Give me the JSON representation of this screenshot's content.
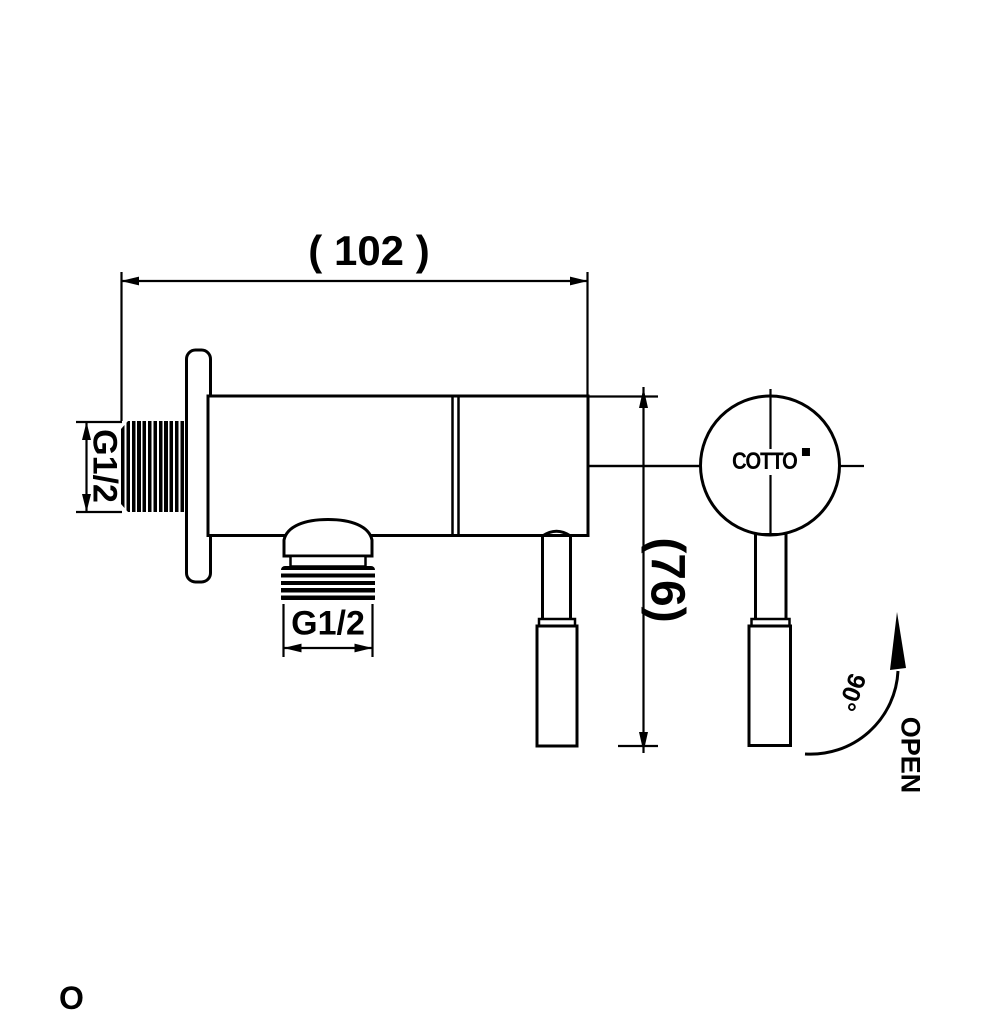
{
  "drawing_labels": {
    "width_dimension": "( 102 )",
    "height_dimension": "(76)",
    "inlet_thread": "G1/2",
    "outlet_thread": "G1/2",
    "brand_logo": "COTTO",
    "rotation_angle": "90°",
    "open_direction": "OPEN",
    "bottom_left_partial_letter": "O"
  },
  "colors": {
    "line": "#000000",
    "background": "#ffffff"
  }
}
